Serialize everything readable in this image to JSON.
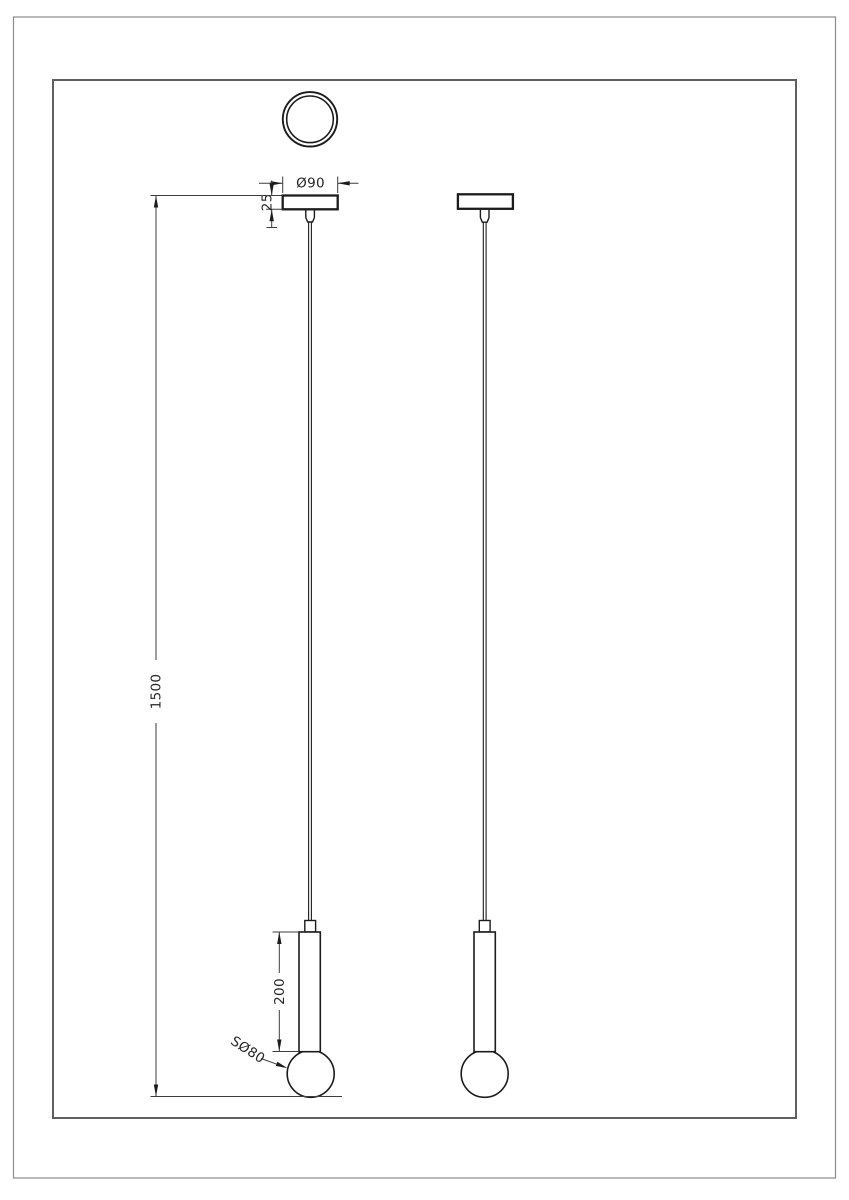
{
  "drawing": {
    "title": "pendant-lamp-technical-drawing",
    "dimensions": {
      "canopy_diameter": "Ø90",
      "canopy_height": "25",
      "suspension_length": "1500",
      "tube_length": "200",
      "sphere_diameter": "SØ80"
    },
    "colors": {
      "background": "#ffffff",
      "object_line": "#1c1c1c",
      "dimension_line": "#3d3d3d",
      "frame_outer": "#8c8c8c",
      "frame_inner": "#606060"
    }
  }
}
